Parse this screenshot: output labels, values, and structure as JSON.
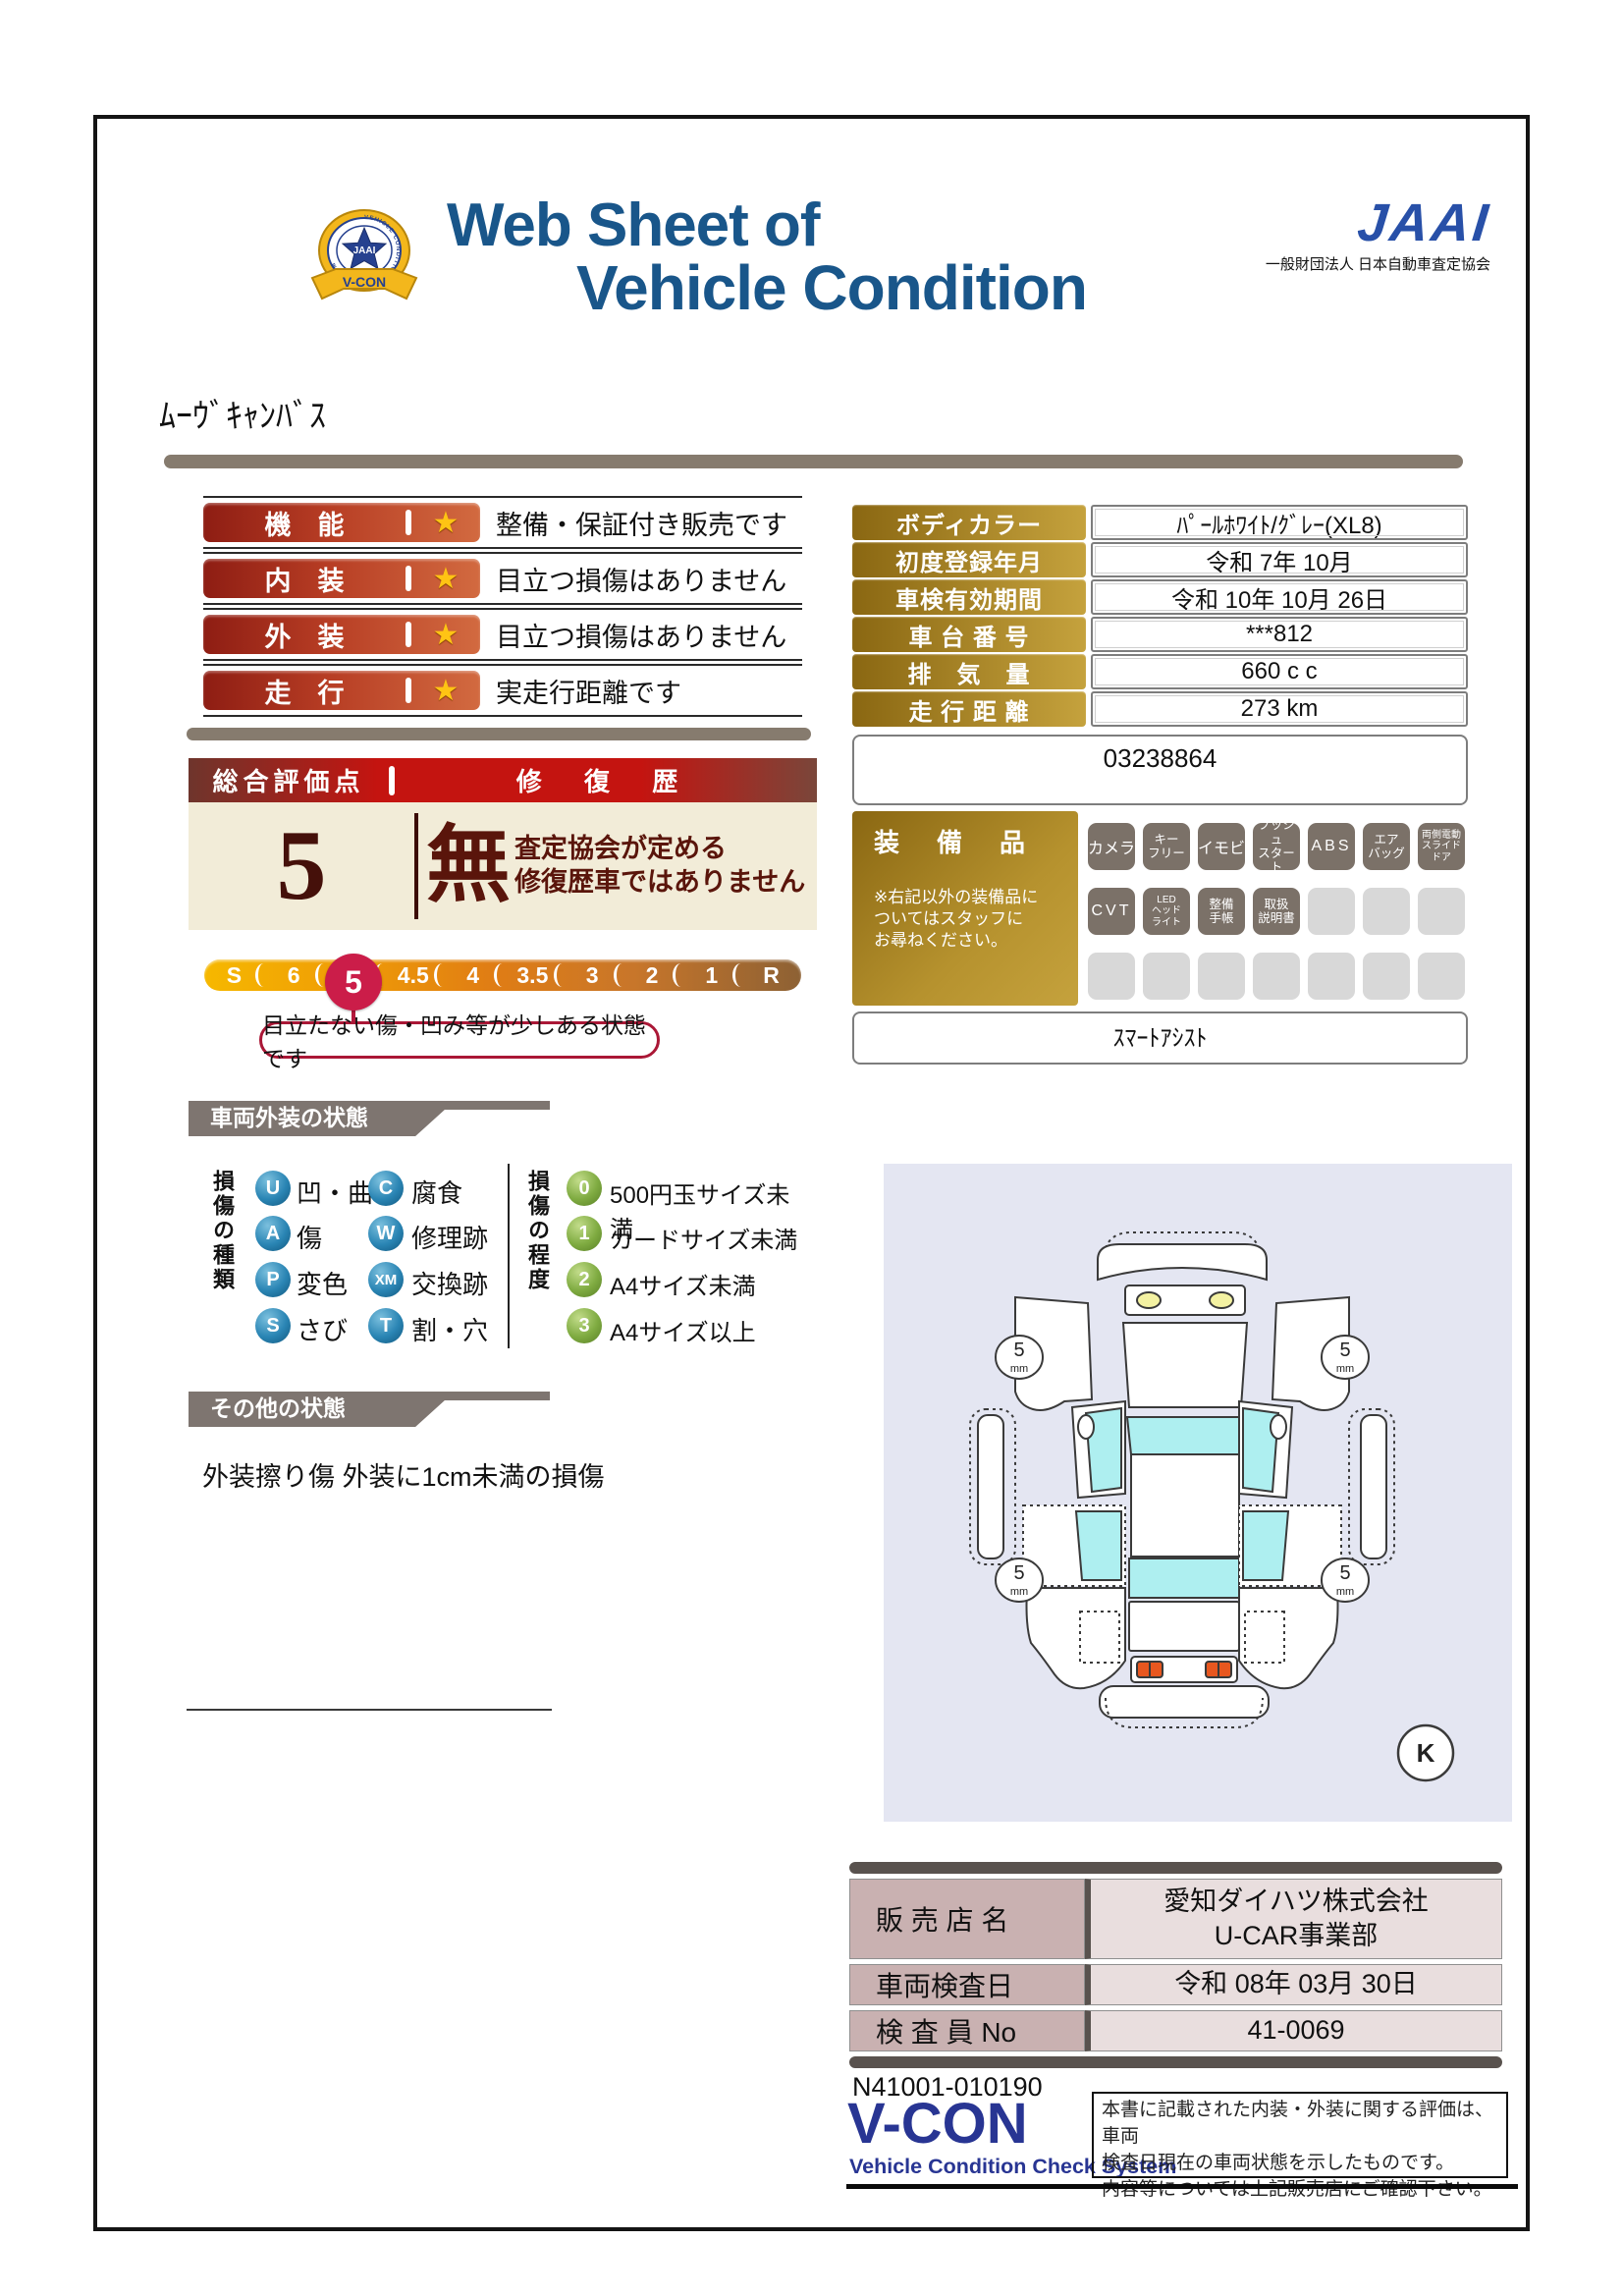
{
  "header": {
    "crest": {
      "vcon": "V-CON",
      "ring_text": "VEHICLE CONDITION CHECK SYSTEM",
      "center": "JAAI"
    },
    "title_line1": "Web Sheet of",
    "title_line2": "Vehicle Condition",
    "org_logo": "JAAI",
    "org_name": "一般財団法人 日本自動車査定協会"
  },
  "vehicle_name": "ﾑｰｳﾞｷｬﾝﾊﾞｽ",
  "ratings": [
    {
      "label": "機　能",
      "star": "★",
      "comment": "整備・保証付き販売です"
    },
    {
      "label": "内　装",
      "star": "★",
      "comment": "目立つ損傷はありません"
    },
    {
      "label": "外　装",
      "star": "★",
      "comment": "目立つ損傷はありません"
    },
    {
      "label": "走　行",
      "star": "★",
      "comment": "実走行距離です"
    }
  ],
  "overall": {
    "header_left": "総合評価点",
    "header_right": "修 復 歴",
    "score": "5",
    "repair_mark": "無",
    "repair_note": "査定協会が定める\n修復歴車ではありません"
  },
  "scale": {
    "segments": [
      "S",
      "6",
      "5",
      "4.5",
      "4",
      "3.5",
      "3",
      "2",
      "1",
      "R"
    ],
    "selected": "5",
    "callout": "目立たない傷・凹み等が少しある状態です"
  },
  "info": {
    "rows": [
      {
        "label": "ボディカラー",
        "value": "ﾊﾟｰﾙﾎﾜｲﾄ/ｸﾞﾚｰ(XL8)"
      },
      {
        "label": "初度登録年月",
        "value": "令和 7年 10月"
      },
      {
        "label": "車検有効期間",
        "value": "令和 10年 10月 26日"
      },
      {
        "label": "車 台 番 号",
        "value": "***812"
      },
      {
        "label": "排　気　量",
        "value": "660 c c"
      },
      {
        "label": "走 行 距 離",
        "value": "273 km"
      }
    ],
    "ref_number": "03238864"
  },
  "equipment": {
    "title": "装　備　品",
    "note": "※右記以外の装備品に\nついてはスタッフに\nお尋ねください。",
    "badges": [
      "カメラ",
      "キー\nフリー",
      "イモビ",
      "プッシュ\nスタート",
      "ABS",
      "エア\nバッグ",
      "両側電動\nスライド\nドア",
      "CVT",
      "LED\nヘッド\nライト",
      "整備\n手帳",
      "取扱\n説明書",
      "",
      "",
      "",
      "",
      "",
      "",
      "",
      "",
      "",
      ""
    ],
    "smart_assist": "ｽﾏｰﾄｱｼｽﾄ"
  },
  "exterior": {
    "title": "車両外装の状態",
    "type_title": "損傷の種類",
    "types": [
      {
        "code": "U",
        "label": "凹・曲"
      },
      {
        "code": "C",
        "label": "腐食"
      },
      {
        "code": "A",
        "label": "傷"
      },
      {
        "code": "W",
        "label": "修理跡"
      },
      {
        "code": "P",
        "label": "変色"
      },
      {
        "code": "XM",
        "label": "交換跡"
      },
      {
        "code": "S",
        "label": "さび"
      },
      {
        "code": "T",
        "label": "割・穴"
      }
    ],
    "degree_title": "損傷の程度",
    "degrees": [
      {
        "code": "0",
        "label": "500円玉サイズ未満"
      },
      {
        "code": "1",
        "label": "カードサイズ未満"
      },
      {
        "code": "2",
        "label": "A4サイズ未満"
      },
      {
        "code": "3",
        "label": "A4サイズ以上"
      }
    ]
  },
  "other": {
    "title": "その他の状態",
    "note": "外装擦り傷 外装に1cm未満の損傷"
  },
  "diagram": {
    "tire_depth": "5",
    "tire_unit": "mm",
    "k_mark": "K"
  },
  "dealer": {
    "rows": [
      {
        "label": "販 売 店 名",
        "value": "愛知ダイハツ株式会社\nU-CAR事業部"
      },
      {
        "label": "車両検査日",
        "value": "令和 08年 03月 30日"
      },
      {
        "label": "検 査 員 No",
        "value": "41-0069"
      }
    ]
  },
  "footer": {
    "doc_number": "N41001-010190",
    "vcon": "V-CON",
    "vcon_sub": "Vehicle Condition Check System",
    "disclaimer": "本書に記載された内装・外装に関する評価は、車両\n検査日現在の車両状態を示したものです。\n内容等については上記販売店にご確認下さい。"
  }
}
